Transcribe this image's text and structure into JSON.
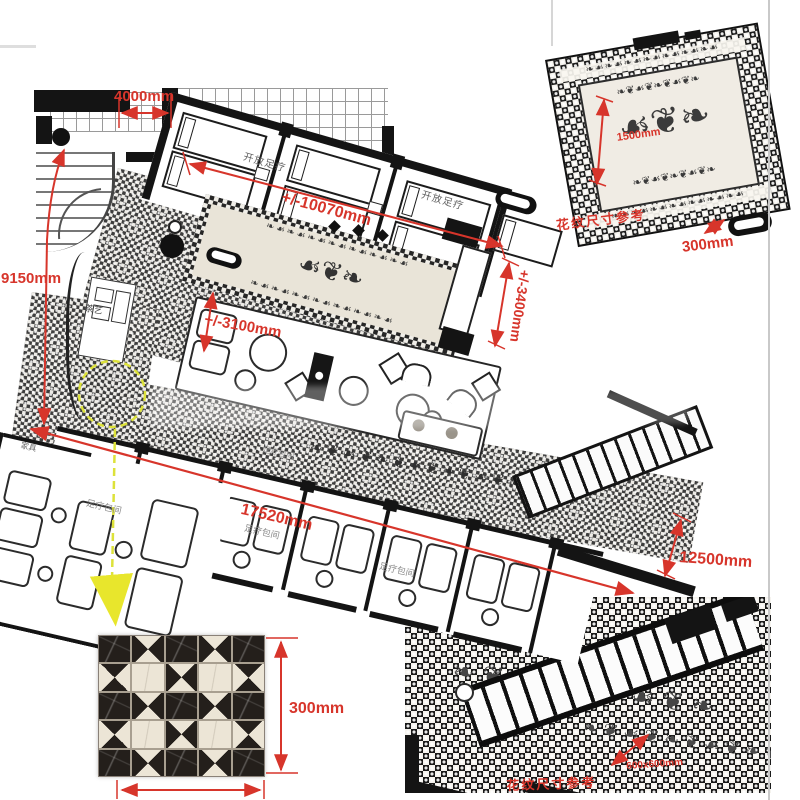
{
  "colors": {
    "dimension_red": "#d7352b",
    "highlight_yellow": "#e2e53a",
    "wall_black": "#141414",
    "page_background": "#ffffff"
  },
  "plan_labels": {
    "open_foot_therapy_1": "开放足疗",
    "open_foot_therapy_2": "开放足疗",
    "tea_art": "茶艺",
    "furniture": "家具",
    "foot_room_1": "足疗包间",
    "foot_room_2": "足疗包间",
    "foot_room_3": "足疗包间",
    "foot_room_small": "足疗包间"
  },
  "dimensions": {
    "top_width": "4000mm",
    "open_area_length": "+/-10070mm",
    "left_height": "9150mm",
    "lounge_width": "+/-3100mm",
    "right_height": "+/-3400mm",
    "corridor_length": "17520mm",
    "right_diagonal": "12500mm"
  },
  "detail_top": {
    "caption": "花纹尺寸参考",
    "inner_dim": "1500mm",
    "tile_dim": "300mm"
  },
  "detail_bottom": {
    "caption": "花纹尺寸参考",
    "inner_dim": "600x600mm"
  },
  "tile_sample": {
    "height_dim": "300mm"
  },
  "decor": {
    "border_row": "❧☙❧☙❧☙❧☙❧☙❧☙❧☙",
    "scroll_row": "❧❦☙❦❧❦☙❦❧",
    "scroll_row_small": "❧❦☙❦❧❦☙❦❧❦☙❦❧",
    "medallion": "☙❦❧"
  }
}
